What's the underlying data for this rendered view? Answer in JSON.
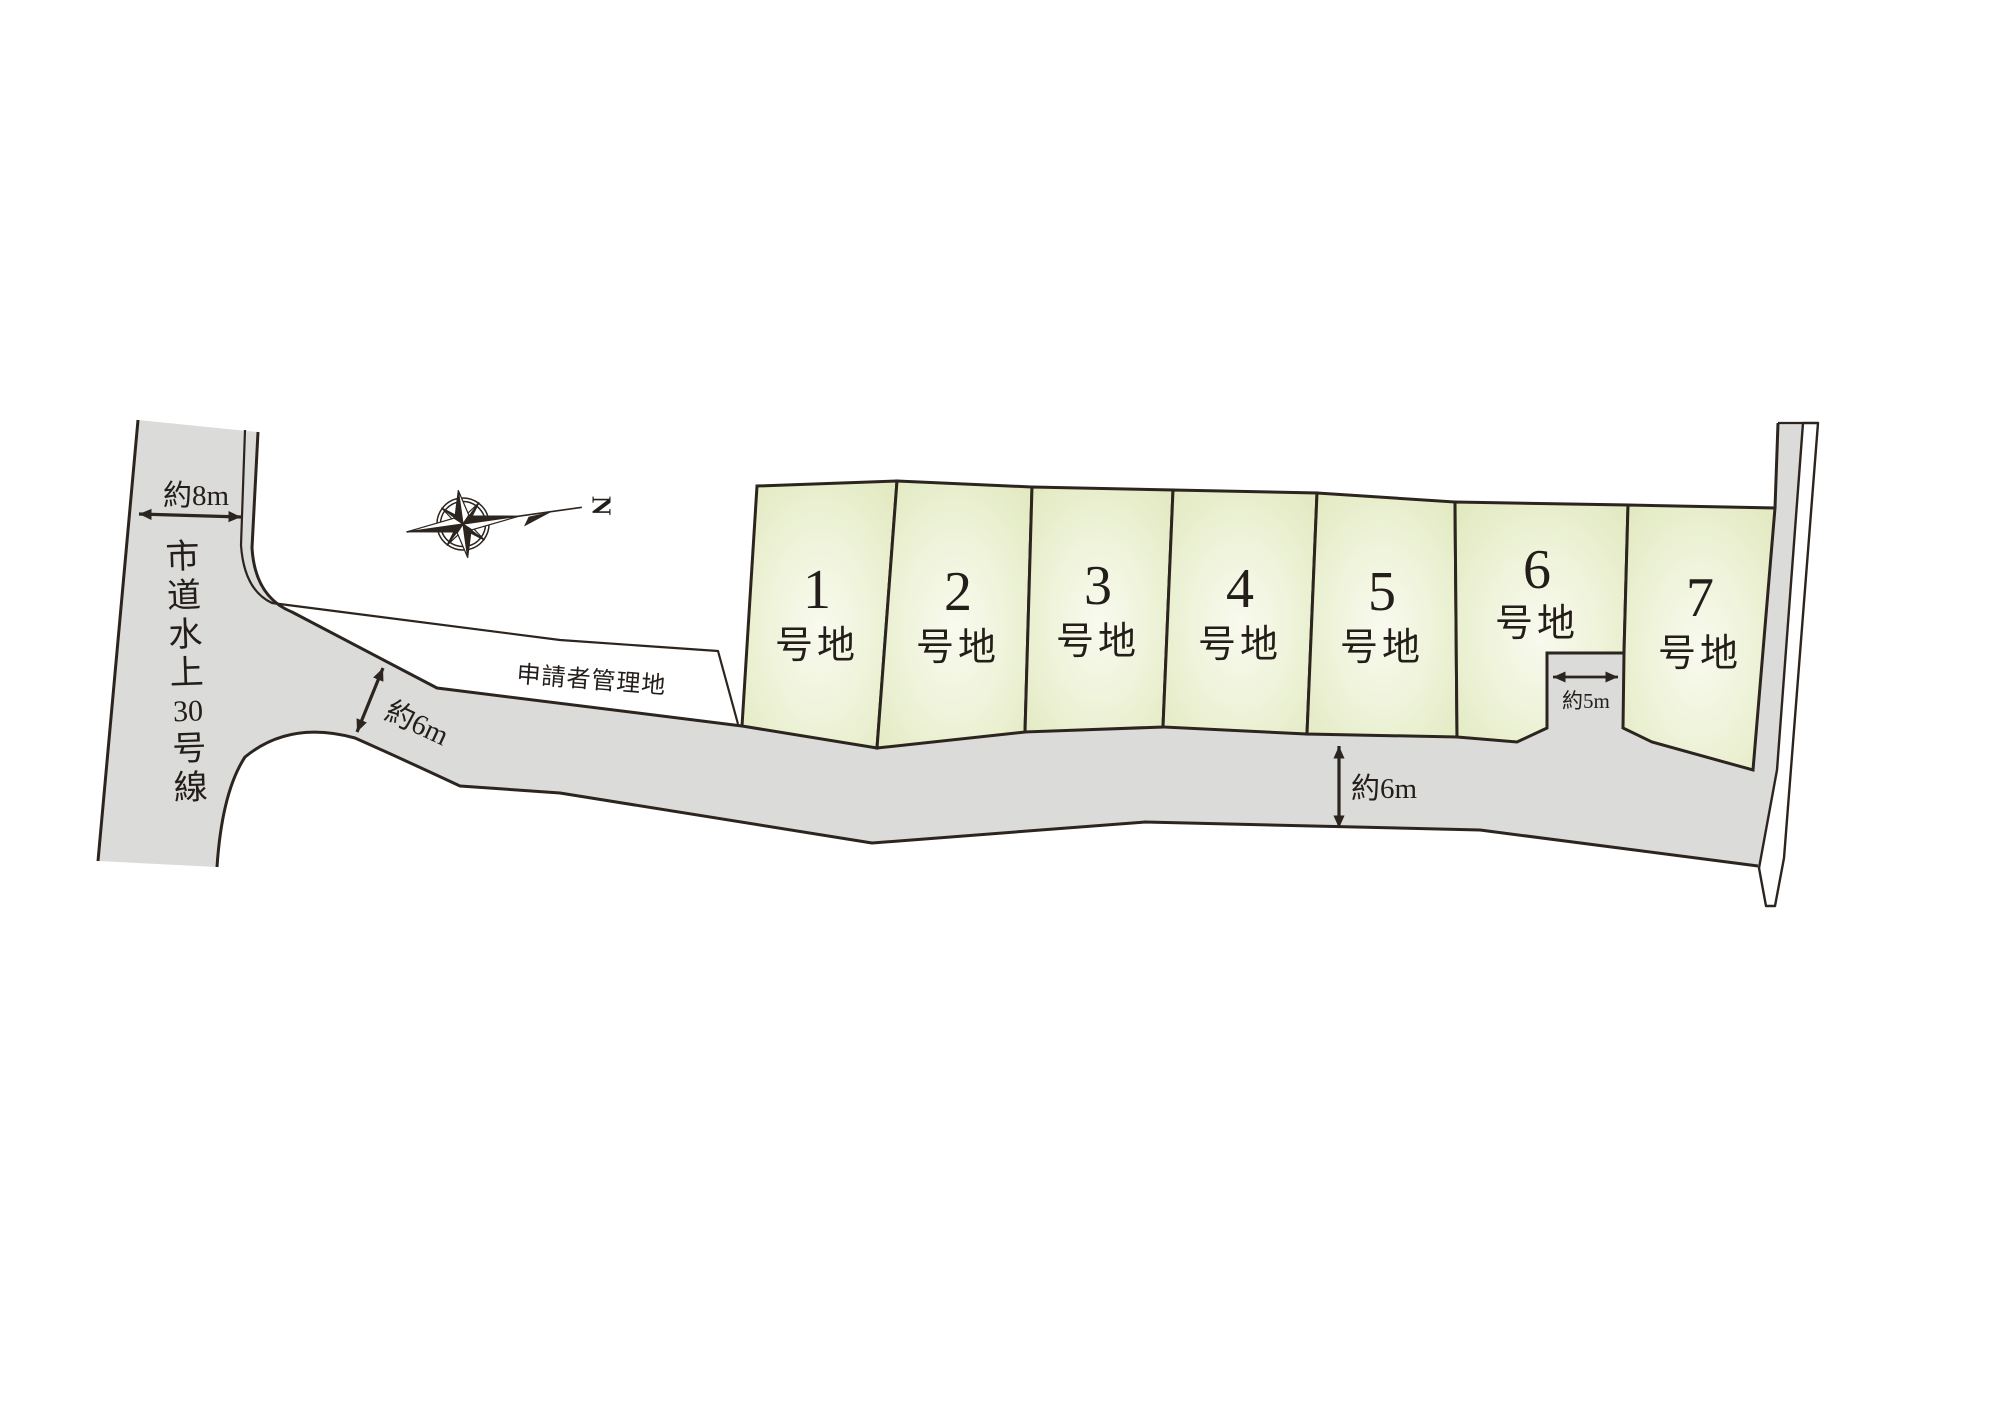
{
  "compass": {
    "north_label": "N"
  },
  "roads": {
    "city_road": {
      "name": "市道水上30号線",
      "chars": [
        "市",
        "道",
        "水",
        "上",
        "30",
        "号",
        "線"
      ]
    }
  },
  "labels": {
    "managed_land": "申請者管理地"
  },
  "lots": [
    {
      "number": "1",
      "suffix": "号地"
    },
    {
      "number": "2",
      "suffix": "号地"
    },
    {
      "number": "3",
      "suffix": "号地"
    },
    {
      "number": "4",
      "suffix": "号地"
    },
    {
      "number": "5",
      "suffix": "号地"
    },
    {
      "number": "6",
      "suffix": "号地"
    },
    {
      "number": "7",
      "suffix": "号地"
    }
  ],
  "dimensions": {
    "west_road_width": "約8m",
    "branch_road_width": "約6m",
    "south_road_width": "約6m",
    "driveway_width": "約5m"
  },
  "colors": {
    "road_fill": "#dbdbda",
    "lot_edge": "#dfe7bb",
    "lot_mid": "#eef3d9",
    "lot_center": "#f8faee",
    "river": "#a6d6f2",
    "line": "#2c241e",
    "text": "#241e1a"
  }
}
